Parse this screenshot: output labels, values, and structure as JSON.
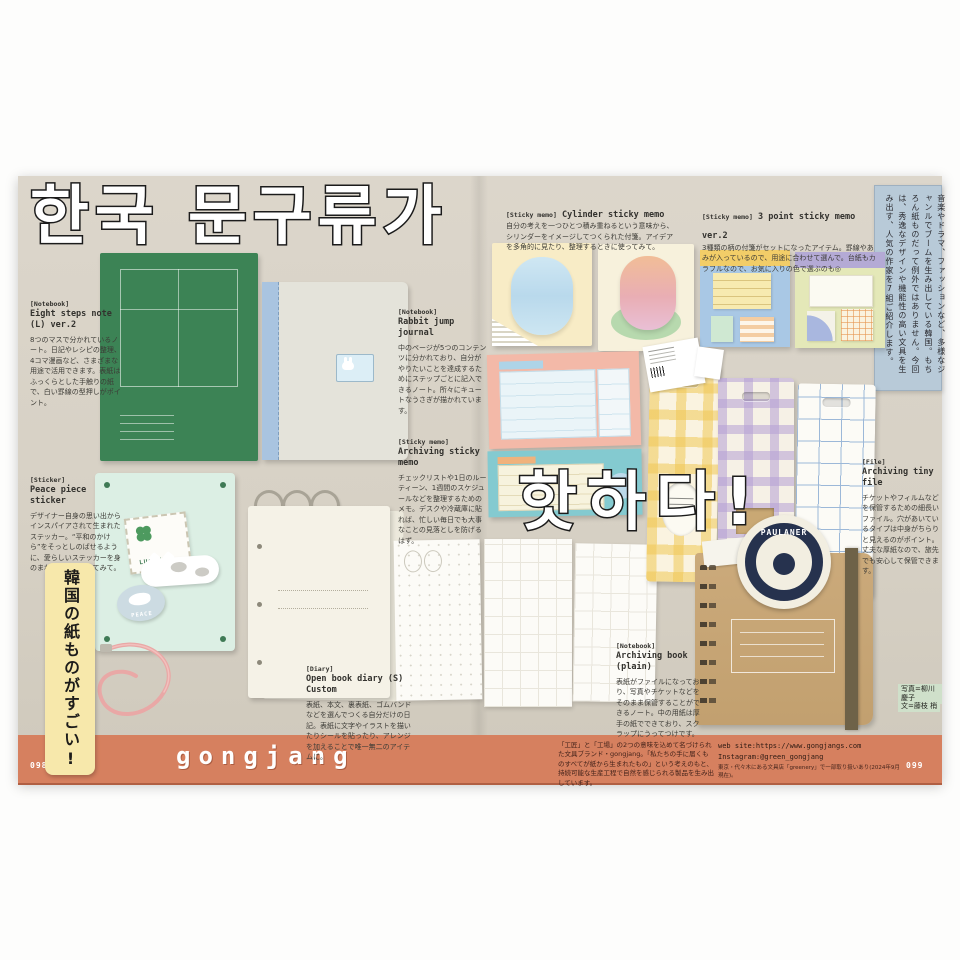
{
  "page": {
    "title_korean_1": "한국 문구류가",
    "title_korean_2": "핫하다!",
    "side_ribbon": "韓国の紙ものがすごい!",
    "intro_box": "音楽やドラマ、ファッションなど、多様なジャンルでブームを生み出している韓国。もちろん紙ものだって例外ではありません。今回は、秀逸なデザインや機能性の高い文具を生み出す、人気の作家を7組ご紹介します。",
    "left_page_number": "098",
    "right_page_number": "099"
  },
  "articles": [
    {
      "category": "[Notebook]",
      "title": "Eight steps note (L) ver.2",
      "body": "8つのマスで分かれているノート。日記やレシピの整理、4コマ漫画など、さまざまな用途で活用できます。表紙はふっくらとした手触りの紙で、白い罫線の型押しがポイント。"
    },
    {
      "category": "[Sticker]",
      "title": "Peace piece sticker",
      "body": "デザイナー自身の思い出からインスパイアされて生まれたステッカー。“平和のかけら”をそっとしのばせるように、愛らしいステッカーを身のまわりのもの貼ってみて。"
    },
    {
      "category": "[Notebook]",
      "title": "Rabbit jump journal",
      "body": "中のページが5つのコンテンツに分かれており、自分がやりたいことを達成するためにステップごとに記入できるノート。所々にキュートなうさぎが描かれています。"
    },
    {
      "category": "[Sticky memo]",
      "title": "Archiving sticky memo",
      "body": "チェックリストや1日のルーティーン、1週間のスケジュールなどを整理するためのメモ。デスクや冷蔵庫に貼れば、忙しい毎日でも大事なことの見落としを防げるはず。"
    },
    {
      "category": "[Sticky memo]",
      "title": "Cylinder sticky memo",
      "body": "自分の考えを一つひとつ積み重ねるという意味から、シリンダーをイメージしてつくられた付箋。アイデアを多角的に見たり、整理するときに使ってみて。"
    },
    {
      "category": "[Sticky memo]",
      "title": "3 point sticky memo ver.2",
      "body": "3種類の柄の付箋がセットになったアイテム。罫線やあみが入っているので、用途に合わせて選んで。台紙もカラフルなので、お気に入りの色で選ぶのも◎"
    },
    {
      "category": "[File]",
      "title": "Archiving tiny file",
      "body": "チケットやフィルムなどを保管するための細長いファイル。穴があいているタイプは中身がちらりと見えるのがポイント。丈夫な厚紙なので、旅先でも安心して保管できます。"
    },
    {
      "category": "[Notebook]",
      "title": "Archiving book (plain)",
      "body": "表紙がファイルになっており、写真やチケットなどをそのまま保管することができるノート。中の用紙は厚手の紙でできており、スクラップにうってつけです。"
    },
    {
      "category": "[Diary]",
      "title": "Open book diary (S) Custom",
      "body": "表紙、本文、裏表紙、ゴムバンドなどを選んでつくる自分だけの日記。表紙に文字やイラストを描いたりシールを貼ったり、アレンジを加えることで唯一無二のアイテムに。"
    }
  ],
  "products": {
    "stamp_sticker": "LUCKY",
    "dove_sticker": "PEACE",
    "coaster": "PAULANER"
  },
  "credits": {
    "photo": "写真=柳川慶子",
    "text": "文=藤枝 梢"
  },
  "footer": {
    "brand": "gongjang",
    "description": "「工匠」と「工場」の2つの意味を込めて名づけられた文具ブランド・gongjang。「私たちの手に届くものすべてが紙から生まれたもの」という考えのもと、持続可能な生産工程で自然を感じられる製品を生み出しています。",
    "web": "web site:https://www.gongjangs.com",
    "instagram": "Instagram:@green_gongjang",
    "note": "東京・代々木にある文具店「greenery」で一部取り扱いあり(2024年9月現在)。"
  },
  "colors": {
    "band": "#d6805f",
    "spread_bg": "#d7d1c5",
    "intro_box": "#b8cad8",
    "ribbon": "#f7e8ab",
    "green_notebook": "#3c8355"
  }
}
